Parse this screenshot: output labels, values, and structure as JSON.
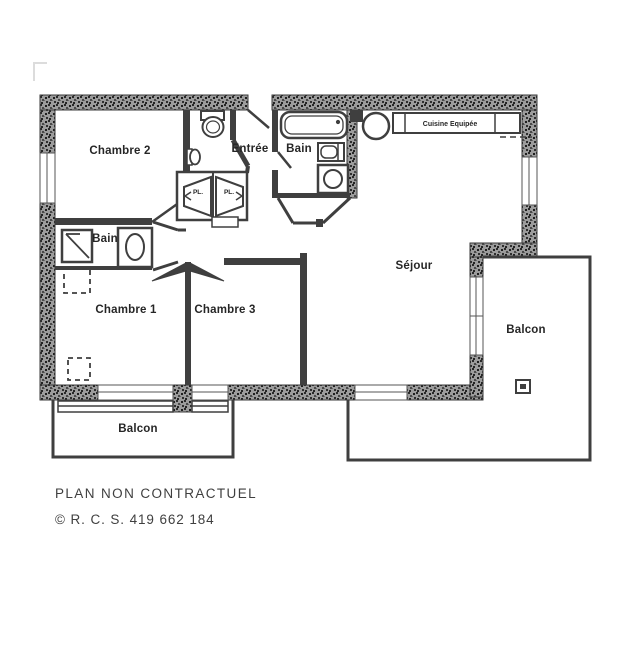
{
  "plan": {
    "rooms": {
      "chambre2": "Chambre 2",
      "entree": "Entrée",
      "bain_top": "Bain",
      "cuisine": "Cuisine Equipée",
      "bain_left": "Bain",
      "chambre1": "Chambre 1",
      "chambre3": "Chambre 3",
      "sejour": "Séjour",
      "balcon_left": "Balcon",
      "balcon_right": "Balcon",
      "closet_left": "PL.",
      "closet_right": "PL."
    }
  },
  "footer": {
    "line1": "PLAN NON CONTRACTUEL",
    "line2": "© R. C. S. 419 662 184"
  },
  "colors": {
    "wall_dark": "#3f3f3f",
    "wall_speckle_base": "#9c9c9c",
    "paper": "#ffffff",
    "label_text": "#262626",
    "footer_text": "#3f3f3f"
  }
}
